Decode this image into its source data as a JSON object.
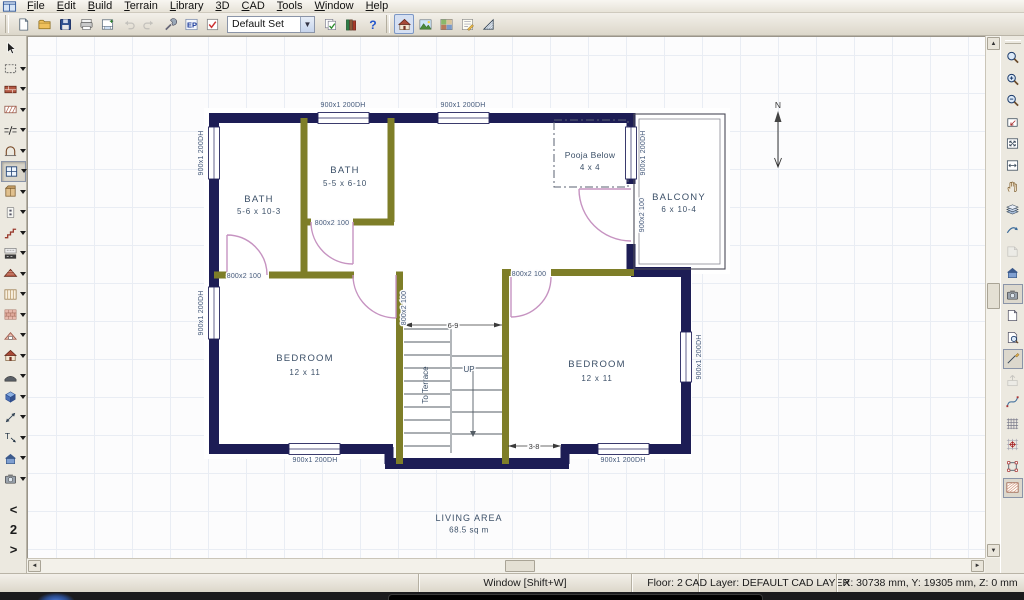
{
  "menu_bar": {
    "items": [
      "File",
      "Edit",
      "Build",
      "Terrain",
      "Library",
      "3D",
      "CAD",
      "Tools",
      "Window",
      "Help"
    ]
  },
  "toolbar": {
    "default_set_label": "Default Set",
    "file_group": [
      {
        "name": "new-file-button",
        "icon": "newdoc"
      },
      {
        "name": "open-file-button",
        "icon": "folder"
      },
      {
        "name": "save-button",
        "icon": "save"
      },
      {
        "name": "print-button",
        "icon": "print"
      },
      {
        "name": "layout-page-button",
        "icon": "plancheck"
      },
      {
        "name": "undo-button",
        "icon": "undo",
        "disabled": true
      },
      {
        "name": "redo-button",
        "icon": "redo",
        "disabled": true
      },
      {
        "name": "settings-button",
        "icon": "wrench"
      },
      {
        "name": "default-sets-button",
        "icon": "epicon"
      },
      {
        "name": "preferences-button",
        "icon": "prefcheck"
      }
    ],
    "library_group": [
      {
        "name": "copy-defaults-button",
        "icon": "copycheck"
      },
      {
        "name": "library-browser-button",
        "icon": "books"
      },
      {
        "name": "help-button",
        "icon": "helpq"
      }
    ],
    "view_group": [
      {
        "name": "plan-view-button",
        "icon": "viewplan",
        "active": true
      },
      {
        "name": "terrain-view-button",
        "icon": "viewterrain"
      },
      {
        "name": "materials-view-button",
        "icon": "viewmaterials"
      },
      {
        "name": "notes-view-button",
        "icon": "viewnotes"
      },
      {
        "name": "elevation-view-button",
        "icon": "viewelevation"
      }
    ]
  },
  "left_toolbar": {
    "tools": [
      {
        "name": "select-tool",
        "icon": "pointer"
      },
      {
        "name": "marquee-select-tool",
        "icon": "marquee",
        "arrow": true
      },
      {
        "name": "exterior-wall-tool",
        "icon": "wallbrick",
        "arrow": true
      },
      {
        "name": "interior-wall-tool",
        "icon": "wallhatch",
        "arrow": true
      },
      {
        "name": "wall-break-tool",
        "icon": "breakwall",
        "arrow": true
      },
      {
        "name": "door-tool",
        "icon": "archdoor",
        "arrow": true
      },
      {
        "name": "window-tool",
        "icon": "windowtool",
        "arrow": true,
        "active": true
      },
      {
        "name": "cabinet-tool",
        "icon": "cabinet",
        "arrow": true
      },
      {
        "name": "electrical-tool",
        "icon": "outlet",
        "arrow": true
      },
      {
        "name": "stairs-tool",
        "icon": "stairs",
        "arrow": true
      },
      {
        "name": "fixture-tool",
        "icon": "fixturegrid",
        "arrow": true
      },
      {
        "name": "roof-tool",
        "icon": "roof",
        "arrow": true
      },
      {
        "name": "framing-tool",
        "icon": "framing",
        "arrow": true
      },
      {
        "name": "floor-material-tool",
        "icon": "shingles",
        "arrow": true
      },
      {
        "name": "dormer-tool",
        "icon": "dormer",
        "arrow": true
      },
      {
        "name": "house-wizard-tool",
        "icon": "housetool",
        "arrow": true
      },
      {
        "name": "soffit-tool",
        "icon": "soffit",
        "arrow": true
      },
      {
        "name": "primitive-box-tool",
        "icon": "cube",
        "arrow": true
      },
      {
        "name": "dimension-tool",
        "icon": "dimension",
        "arrow": true
      },
      {
        "name": "text-callout-tool",
        "icon": "textarrow",
        "arrow": true
      },
      {
        "name": "full-camera-tool",
        "icon": "houseview",
        "arrow": true
      },
      {
        "name": "camera-tool",
        "icon": "camera",
        "arrow": true
      }
    ],
    "floor_nav": {
      "prev": "<",
      "current": "2",
      "next": ">"
    }
  },
  "right_toolbar": {
    "tools": [
      {
        "name": "zoom-tool",
        "icon": "magnifier"
      },
      {
        "name": "zoom-in-button",
        "icon": "magplus"
      },
      {
        "name": "zoom-out-button",
        "icon": "magminus"
      },
      {
        "name": "undo-zoom-button",
        "icon": "zoomprev"
      },
      {
        "name": "fill-window-button",
        "icon": "fillwin"
      },
      {
        "name": "fill-window-building-button",
        "icon": "fillwin2"
      },
      {
        "name": "pan-window-tool",
        "icon": "pan"
      },
      {
        "name": "layer-display-button",
        "icon": "layers"
      },
      {
        "name": "swap-views-button",
        "icon": "swoosh"
      },
      {
        "name": "page-flip-button",
        "icon": "pageturn",
        "disabled": true
      },
      {
        "name": "view-3d-button",
        "icon": "houseview",
        "sep": true
      },
      {
        "name": "camera-view-button",
        "icon": "camera",
        "framed": true
      },
      {
        "name": "new-window-button",
        "icon": "page"
      },
      {
        "name": "print-preview-button",
        "icon": "pagemag"
      },
      {
        "name": "edit-line-button",
        "icon": "editline",
        "framed": true
      },
      {
        "name": "import-button",
        "icon": "importicon",
        "disabled": true
      },
      {
        "name": "spline-tool",
        "icon": "spline"
      },
      {
        "name": "grid-display-button",
        "icon": "gridicon"
      },
      {
        "name": "grid-snap-button",
        "icon": "gridsnap"
      },
      {
        "name": "edit-handles-button",
        "icon": "vectoredit"
      },
      {
        "name": "hatch-tool",
        "icon": "hatchrays",
        "framed": true
      }
    ]
  },
  "plan": {
    "rooms": [
      {
        "name": "BATH",
        "dims": "5-6 x 10-3"
      },
      {
        "name": "BATH",
        "dims": "5-5 x 6-10"
      },
      {
        "name": "Pooja Below",
        "dims": "4 x 4"
      },
      {
        "name": "BALCONY",
        "dims": "6 x 10-4"
      },
      {
        "name": "BEDROOM",
        "dims": "12 x 11"
      },
      {
        "name": "BEDROOM",
        "dims": "12 x 11"
      },
      {
        "name": "LIVING AREA",
        "dims": "68.5 sq m"
      }
    ],
    "labels": {
      "window": "900x1 200DH",
      "door": "800x2 100",
      "balcony_door": "900x2 100",
      "stairs_up": "UP",
      "stairs_dest": "To Terrace",
      "dim_stairs": "6-9",
      "dim_landing": "3-8",
      "north": "N"
    }
  },
  "status_bar": {
    "tool_hint": "Window [Shift+W]",
    "floor": "Floor: 2",
    "cad_layer": "CAD Layer:  DEFAULT CAD LAYER",
    "coords": "X: 30738 mm, Y: 19305 mm, Z: 0 mm"
  }
}
